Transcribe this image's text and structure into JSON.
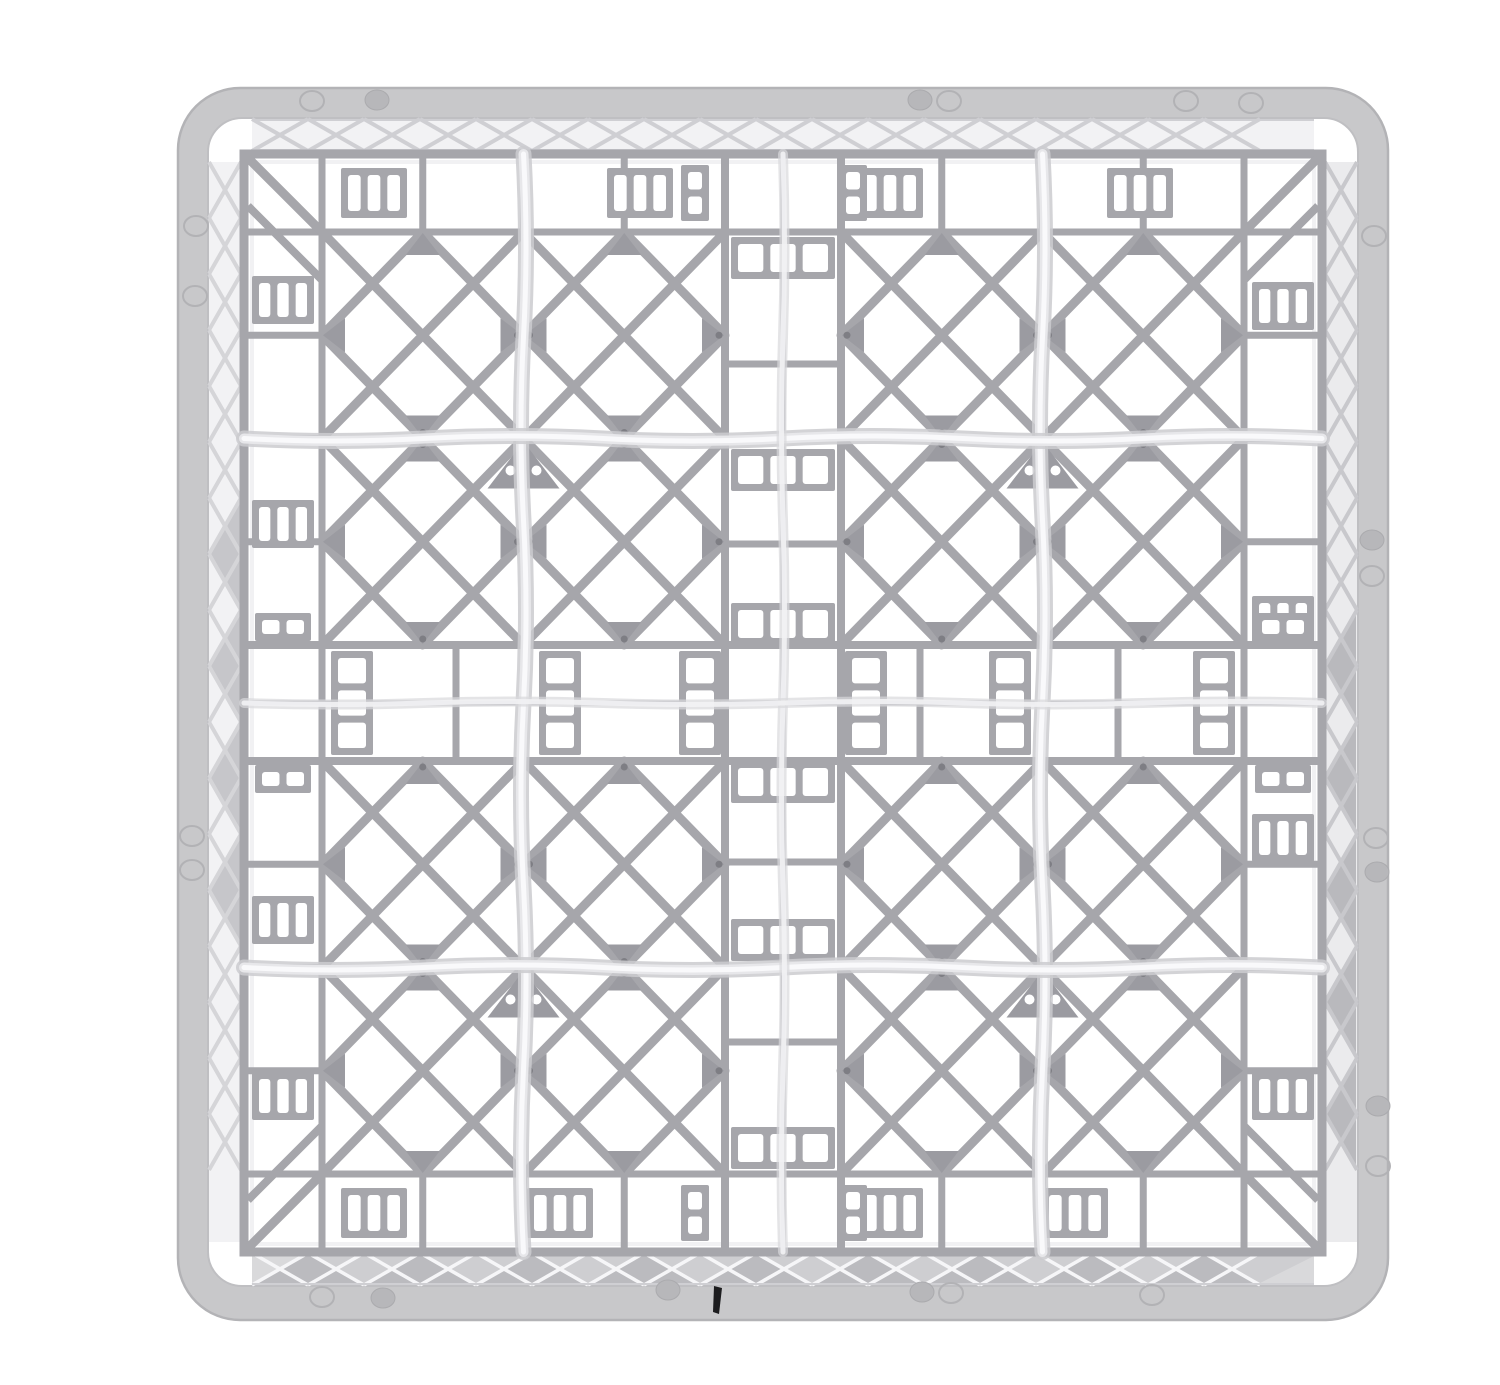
{
  "scene": {
    "description": "Top-down product photo of an empty light-gray plastic commercial dishwasher glass rack with a 4x4 grid of square compartments, X-braced cells, ladder-style central dividers and translucent white divider walls",
    "object": "dishwasher-glass-rack",
    "view": "top-down",
    "compartment_layout": "4x4",
    "compartment_count": 16,
    "background": "#ffffff"
  },
  "palette": {
    "bg": "#ffffff",
    "rim": "#c8c8ca",
    "rimEdge": "#b3b3b6",
    "rimHole": "#bfbfc2",
    "strut": "#a6a6ab",
    "strutThin": "#b0b0b5",
    "gusset": "#9b9ba1",
    "dot": "#7e7e84",
    "stripBgLight": "#f2f2f4",
    "stripLine": "#cfcfd3",
    "stripBgBottom": "#d9d9db",
    "stripTriDark": "#bbbbbf",
    "stripTriLight": "#cbcbce",
    "stripWhite": "#f6f6f8",
    "divShadow": "#cbcbcf",
    "divMid": "#e7e7ea",
    "divCore": "#f9f9fb",
    "divShadow2": "#d8d8db",
    "divCore2": "#f2f2f4",
    "markOutline": "#b2b2b5",
    "markFill": "#b7b7ba",
    "gate": "#1d1d1f",
    "highlight": "#ededf0",
    "slotWhite": "#ffffff"
  },
  "canvas": {
    "w": 1500,
    "h": 1385
  },
  "rim": {
    "outer": {
      "x": 178,
      "y": 88,
      "w": 1210,
      "h": 1232,
      "rx": 62
    },
    "inner": {
      "x": 208,
      "y": 118,
      "w": 1150,
      "h": 1168,
      "rx": 34
    }
  },
  "strips": {
    "period": 112,
    "top": {
      "x0": 252,
      "y0": 119,
      "x1": 1314,
      "y1": 151
    },
    "bottom": {
      "x0": 252,
      "y0": 1253,
      "x1": 1314,
      "y1": 1285
    },
    "left": {
      "x0": 209,
      "y0": 162,
      "x1": 241,
      "y1": 1242
    },
    "right": {
      "x0": 1325,
      "y0": 162,
      "x1": 1357,
      "y1": 1242
    },
    "leftDarkRange": [
      430,
      1010
    ],
    "rightDarkRange": [
      520,
      1242
    ]
  },
  "grid": {
    "outer": {
      "x0": 244,
      "y0": 154,
      "x1": 1322,
      "y1": 1252
    },
    "cellsArea": {
      "x0": 322,
      "y0": 232,
      "x1": 1244,
      "y1": 1174
    },
    "cols": [
      [
        322,
        523.5
      ],
      [
        523.5,
        725
      ],
      [
        841,
        1042.5
      ],
      [
        1042.5,
        1244
      ]
    ],
    "rows": [
      [
        232,
        438.5
      ],
      [
        438.5,
        645
      ],
      [
        761,
        967.5
      ],
      [
        967.5,
        1174
      ]
    ],
    "vBand": {
      "rails": [
        725,
        841
      ],
      "center": 783,
      "blocks": [
        258,
        470,
        624,
        782,
        940,
        1148
      ],
      "rungs": [
        364,
        544,
        862,
        1042
      ]
    },
    "hBand": {
      "rails": [
        645,
        761
      ],
      "center": 703,
      "blocks": [
        352,
        560,
        700,
        866,
        1010,
        1214
      ],
      "rungs": [
        456,
        920,
        1118
      ]
    },
    "stubsX": [
      322,
      422.75,
      523.5,
      624.25,
      725,
      841,
      941.75,
      1042.5,
      1143.25,
      1244
    ],
    "stubsY": [
      232,
      335.25,
      438.5,
      541.75,
      645,
      761,
      864.25,
      967.5,
      1070.75,
      1174
    ],
    "innerV": [
      523.5,
      1042.5
    ],
    "innerH": [
      438.5,
      967.5
    ]
  },
  "perimeterBlocks": {
    "top": [
      374,
      640,
      890,
      1140
    ],
    "topSmall": [
      695,
      853
    ],
    "bottom": [
      374,
      560,
      890,
      1075
    ],
    "bottomSmall": [
      695,
      853
    ],
    "left": [
      300,
      524,
      920,
      1096
    ],
    "leftSmall": [
      627,
      779
    ],
    "right": [
      306,
      620,
      838,
      1096
    ],
    "rightSmall": [
      627,
      779
    ]
  },
  "dividers": {
    "vertical": [
      523.5,
      1042.5
    ],
    "horizontal": [
      438.5,
      967.5
    ],
    "centerV": 783,
    "centerH": 703,
    "amp": 5,
    "ampCenter": 3
  },
  "moldMarks": [
    {
      "x": 312,
      "y": 101,
      "t": "o"
    },
    {
      "x": 377,
      "y": 100,
      "t": "f"
    },
    {
      "x": 920,
      "y": 100,
      "t": "f"
    },
    {
      "x": 949,
      "y": 101,
      "t": "o"
    },
    {
      "x": 1186,
      "y": 101,
      "t": "o"
    },
    {
      "x": 1251,
      "y": 103,
      "t": "o"
    },
    {
      "x": 196,
      "y": 226,
      "t": "o"
    },
    {
      "x": 195,
      "y": 296,
      "t": "o"
    },
    {
      "x": 192,
      "y": 836,
      "t": "o"
    },
    {
      "x": 192,
      "y": 870,
      "t": "o"
    },
    {
      "x": 1374,
      "y": 236,
      "t": "o"
    },
    {
      "x": 1372,
      "y": 540,
      "t": "f"
    },
    {
      "x": 1372,
      "y": 576,
      "t": "o"
    },
    {
      "x": 1376,
      "y": 838,
      "t": "o"
    },
    {
      "x": 1377,
      "y": 872,
      "t": "f"
    },
    {
      "x": 1378,
      "y": 1106,
      "t": "f"
    },
    {
      "x": 1378,
      "y": 1166,
      "t": "o"
    },
    {
      "x": 322,
      "y": 1297,
      "t": "o"
    },
    {
      "x": 383,
      "y": 1298,
      "t": "f"
    },
    {
      "x": 668,
      "y": 1290,
      "t": "f"
    },
    {
      "x": 922,
      "y": 1292,
      "t": "f"
    },
    {
      "x": 951,
      "y": 1293,
      "t": "o"
    },
    {
      "x": 1152,
      "y": 1295,
      "t": "o"
    }
  ],
  "gateMark": {
    "x": 714,
    "y": 1286
  }
}
